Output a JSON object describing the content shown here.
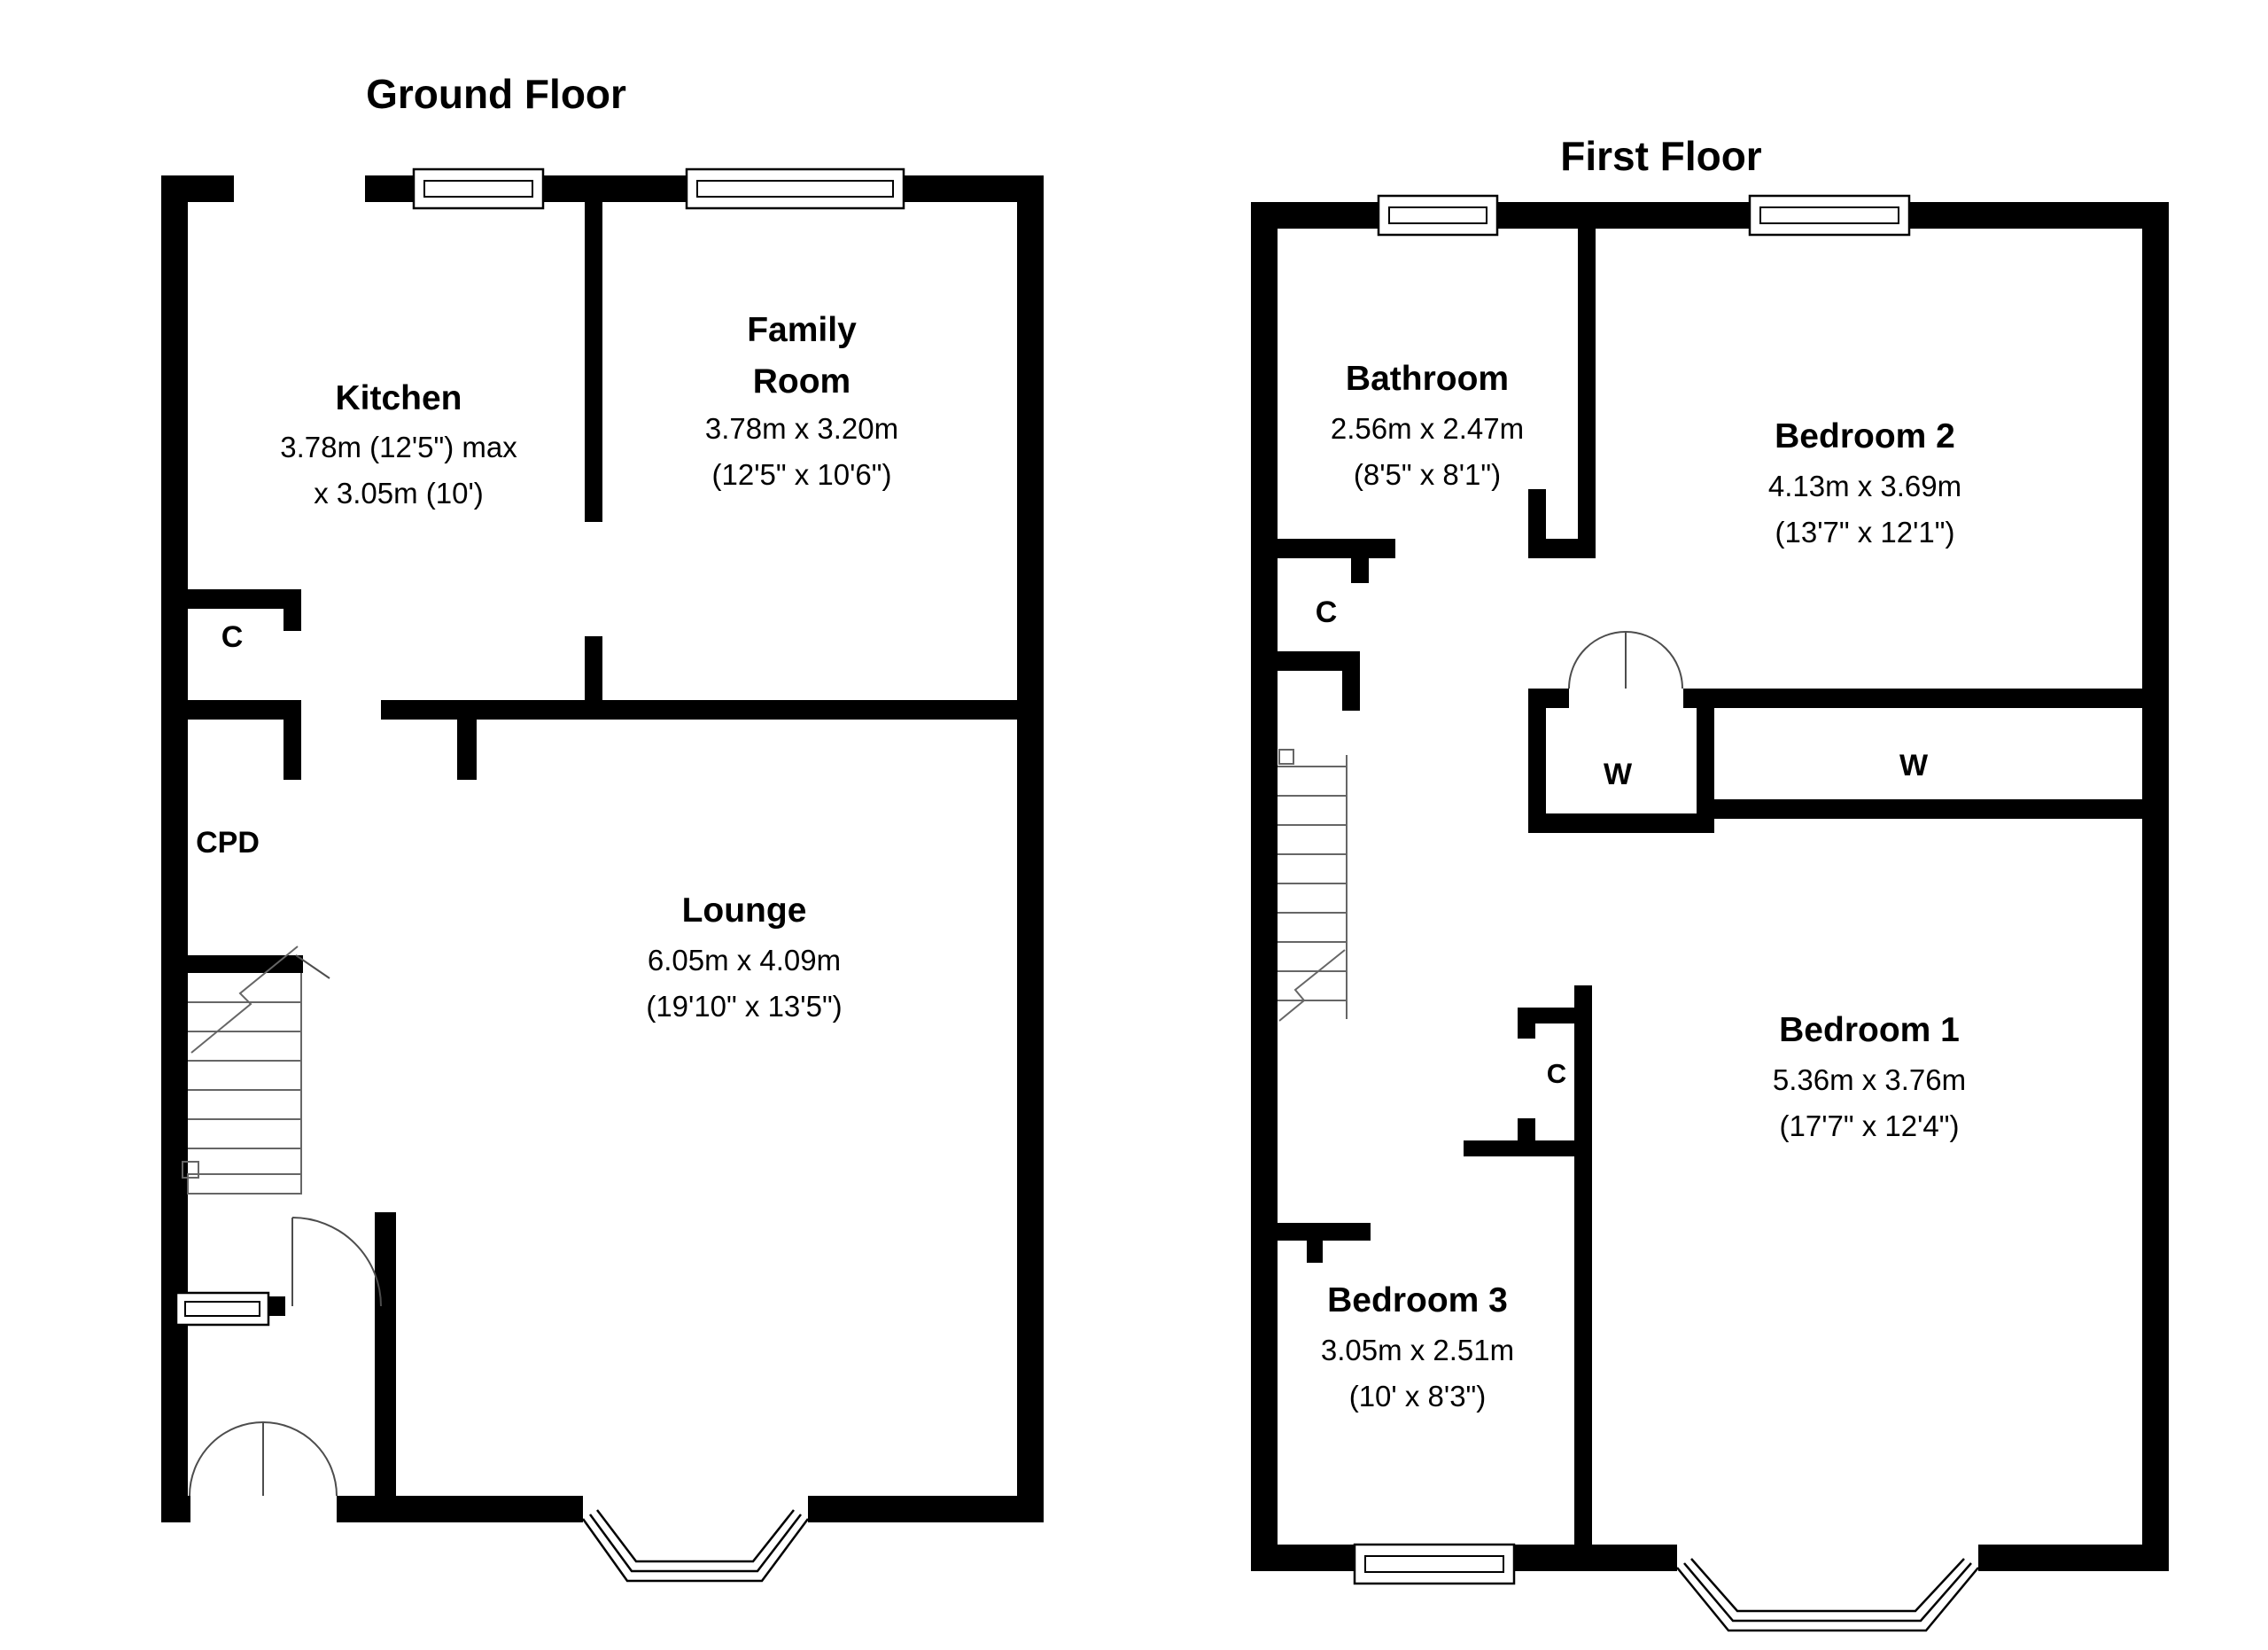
{
  "ground": {
    "title": "Ground Floor",
    "kitchen": {
      "name": "Kitchen",
      "dim1": "3.78m (12'5\") max",
      "dim2": "x 3.05m (10')"
    },
    "family": {
      "name1": "Family",
      "name2": "Room",
      "dim1": "3.78m x 3.20m",
      "dim2": "(12'5\" x 10'6\")"
    },
    "lounge": {
      "name": "Lounge",
      "dim1": "6.05m x 4.09m",
      "dim2": "(19'10\" x 13'5\")"
    },
    "closet_c": "C",
    "closet_cpd": "CPD"
  },
  "first": {
    "title": "First Floor",
    "bathroom": {
      "name": "Bathroom",
      "dim1": "2.56m x 2.47m",
      "dim2": "(8'5\" x 8'1\")"
    },
    "bedroom2": {
      "name": "Bedroom 2",
      "dim1": "4.13m x 3.69m",
      "dim2": "(13'7\" x 12'1\")"
    },
    "bedroom1": {
      "name": "Bedroom 1",
      "dim1": "5.36m x 3.76m",
      "dim2": "(17'7\" x 12'4\")"
    },
    "bedroom3": {
      "name": "Bedroom 3",
      "dim1": "3.05m x 2.51m",
      "dim2": "(10' x 8'3\")"
    },
    "closet_c_landing": "C",
    "closet_w1": "W",
    "closet_w2": "W",
    "closet_c_bed1": "C"
  }
}
